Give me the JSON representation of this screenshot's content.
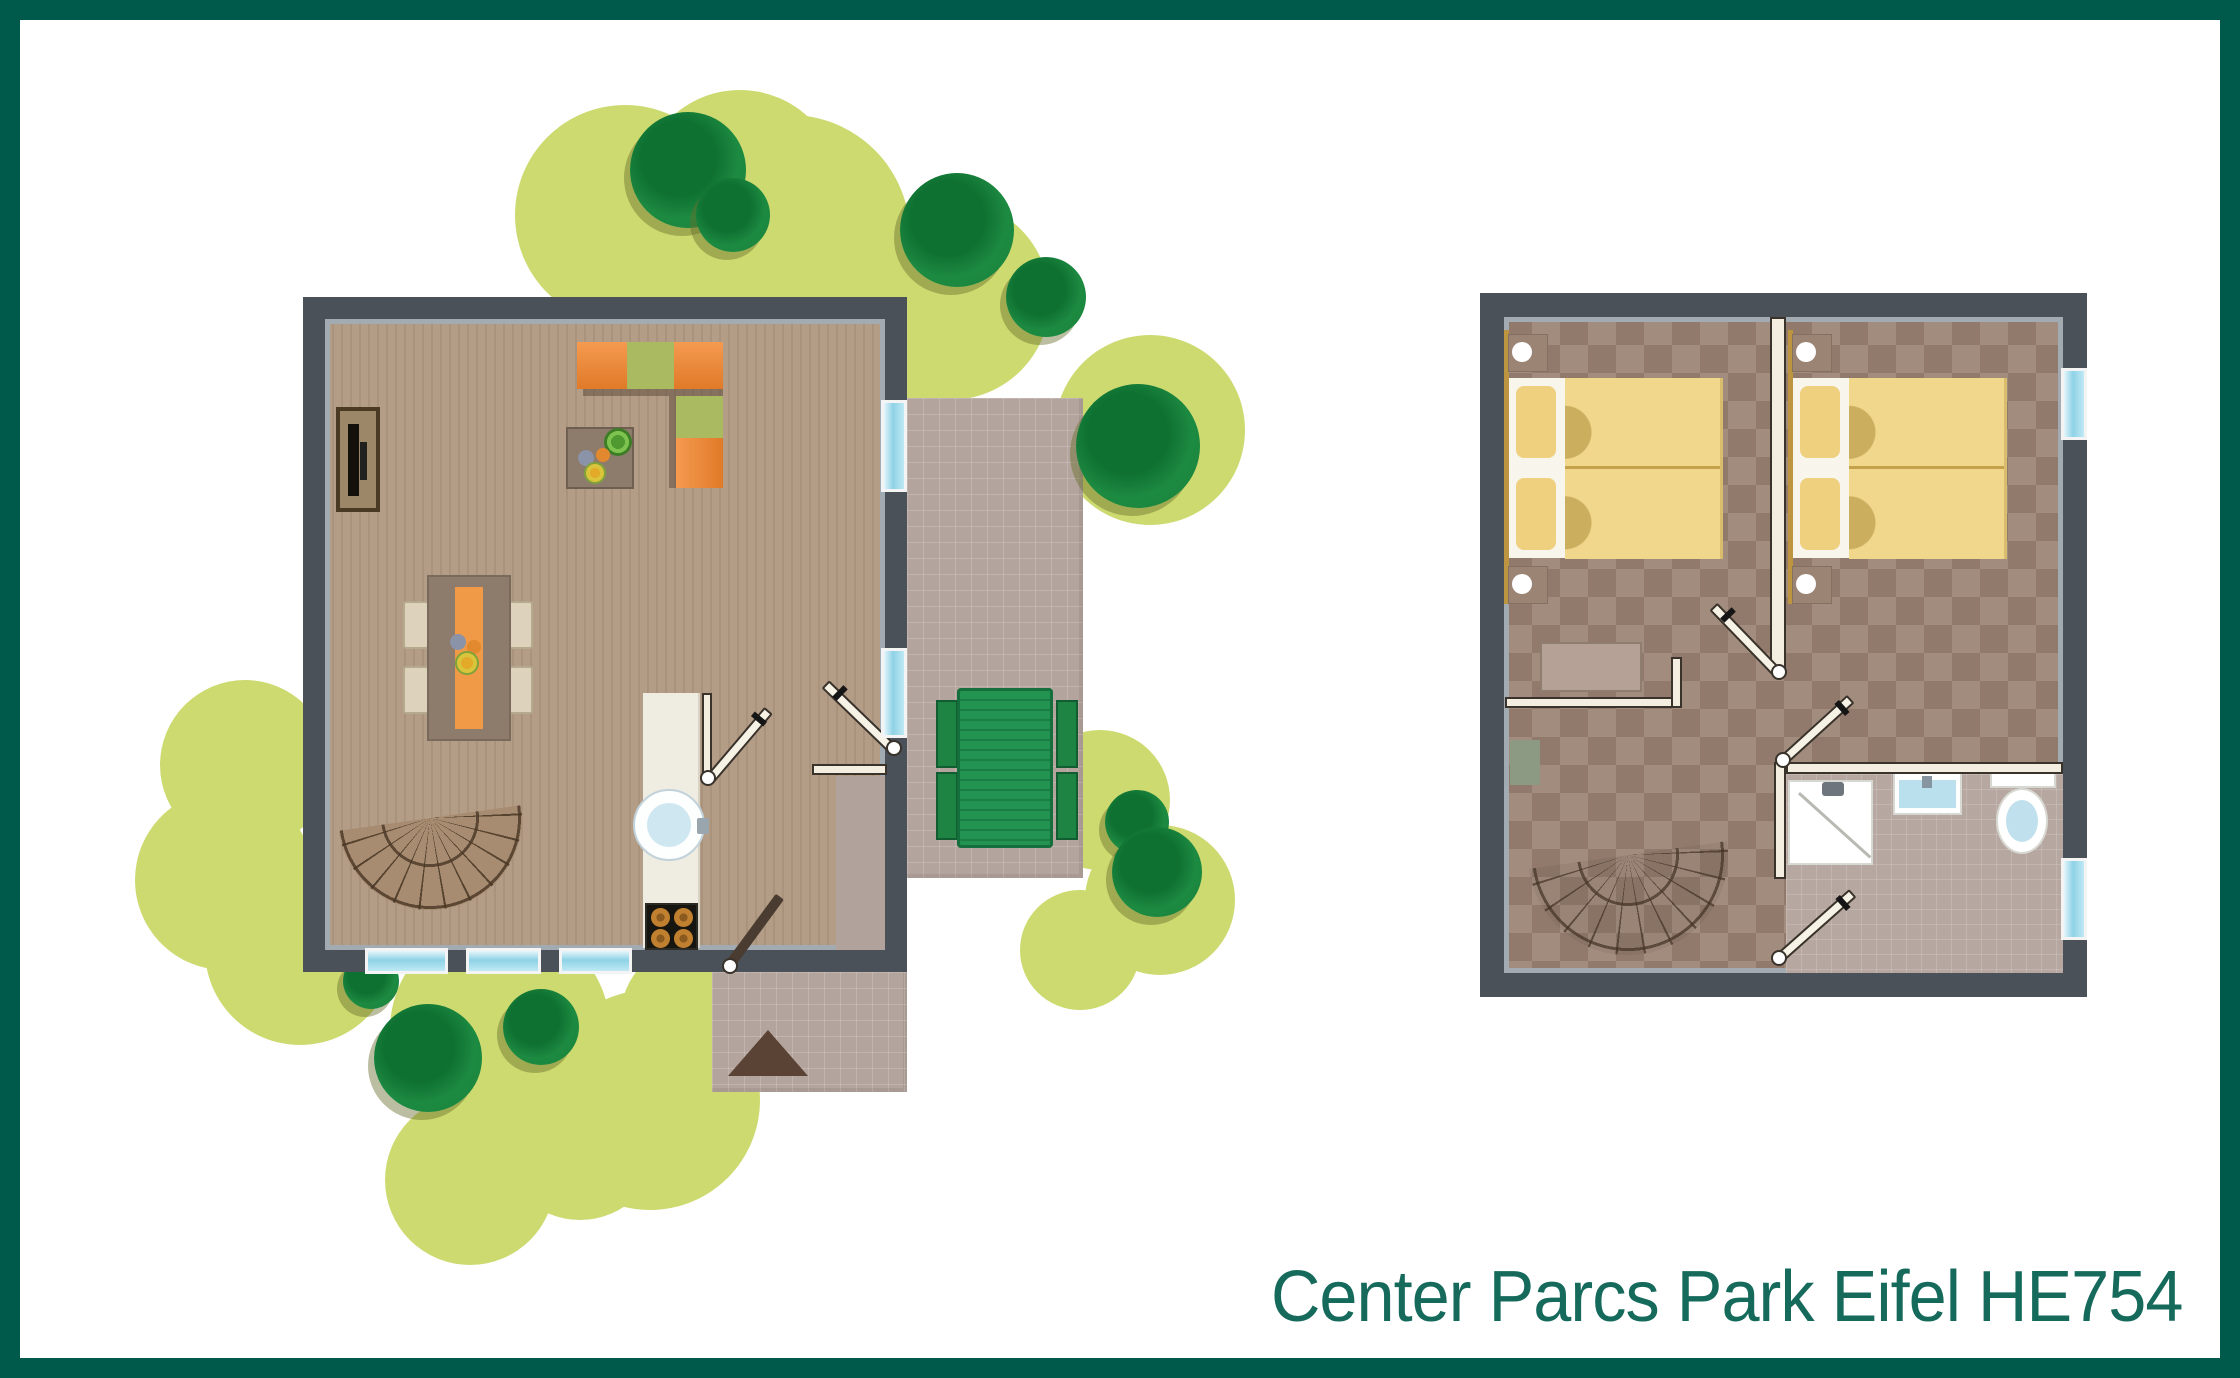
{
  "title": {
    "text": "Center Parcs Park Eifel HE754",
    "color": "#156a5c"
  },
  "frame": {
    "border_color": "#005a4c",
    "background": "#ffffff"
  },
  "palette": {
    "wall": "#4b5158",
    "wall_inner_line": "#a2aab2",
    "wood_floor": "#b29b84",
    "checker_floor": "#9a8272",
    "window_glass": "#8ed2e6",
    "terrace_paving": "#b3a49d",
    "lawn_shrub": "#cdda70",
    "tree_green": "#1d8a41",
    "sofa_orange": "#ee8d40",
    "sofa_green": "#aaba60",
    "bed_linen_yellow": "#f1d78c",
    "bath_blue": "#bfe2ee",
    "picnic_table_green": "#208a4a",
    "stair_tan": "#a78c71",
    "entrance_arrow_brown": "#5a4334"
  },
  "ground_floor": {
    "label": "ground-floor-plan",
    "objects": [
      "tv-cabinet",
      "corner-sofa",
      "coffee-table",
      "potted-plant",
      "dining-table",
      "dining-chairs",
      "kitchen-counter",
      "kitchen-sink",
      "stove",
      "spiral-staircase",
      "interior-doors",
      "entrance-door",
      "windows",
      "entrance-hall"
    ]
  },
  "upper_floor": {
    "label": "upper-floor-plan",
    "objects": [
      "double-bed-left",
      "double-bed-right",
      "nightstands",
      "bed-lamps",
      "dresser",
      "closet-wall",
      "plant-box",
      "spiral-staircase",
      "bathroom",
      "shower",
      "washbasin",
      "toilet",
      "windows"
    ]
  },
  "garden": {
    "objects": [
      "lawn-shrubs",
      "trees",
      "terrace",
      "picnic-table",
      "entrance-porch",
      "entrance-arrow"
    ]
  }
}
